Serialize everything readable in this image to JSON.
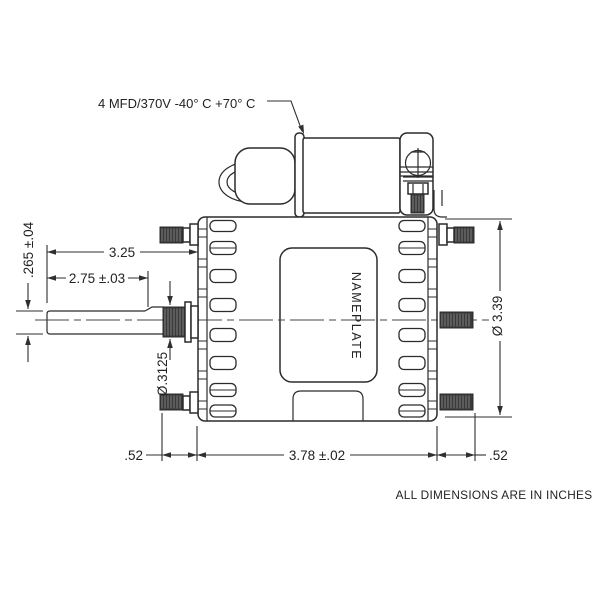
{
  "drawing": {
    "title_note": "ALL DIMENSIONS ARE IN INCHES",
    "capacitor_label": "4 MFD/370V -40° C +70° C",
    "nameplate_label": "NAMEPLATE",
    "dimensions": {
      "shaft_overall_length": "3.25",
      "shaft_exposed_length": "2.75 ±.03",
      "shaft_end_diameter": ".265 ±.04",
      "shaft_hub_diameter": "Ø.3125",
      "body_diameter": "Ø 3.39",
      "body_length": "3.78 ±.02",
      "stud_length_left": ".52",
      "stud_length_right": ".52"
    },
    "colors": {
      "line": "#2b2b2b",
      "background": "#ffffff",
      "thread_fill": "#3a3a3a"
    }
  }
}
